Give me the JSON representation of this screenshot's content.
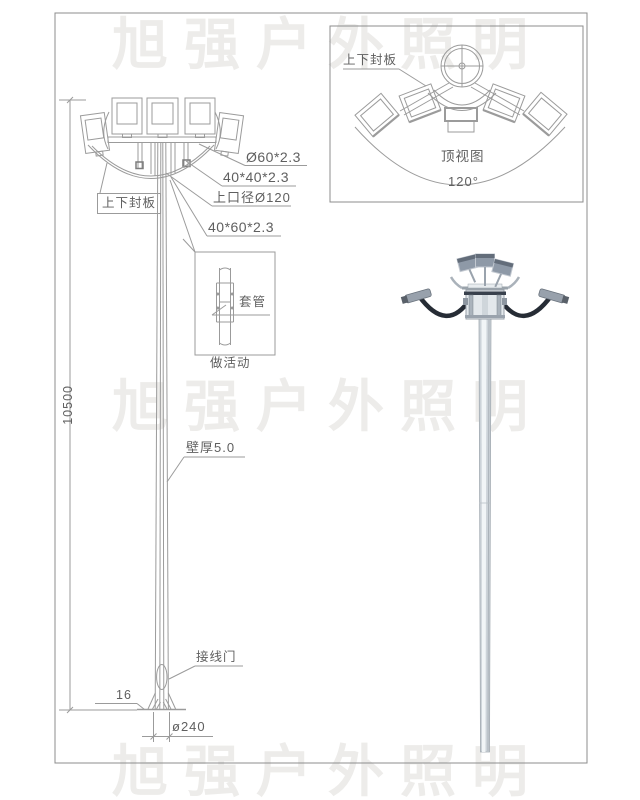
{
  "watermark": {
    "text": "旭强户外照明",
    "color": "#edecea"
  },
  "front_view": {
    "seal_plate": "上下封板",
    "lamp_arm_tube": "Ø60*2.3",
    "square_tube": "40*40*2.3",
    "top_opening": "上口径Ø120",
    "rect_tube": "40*60*2.3",
    "wall_thickness": "壁厚5.0",
    "pole_height": "10500",
    "wiring_door": "接线门",
    "base_plate_thickness": "16",
    "base_diameter": "ø240"
  },
  "sleeve_detail": {
    "sleeve": "套管",
    "caption": "做活动"
  },
  "top_view": {
    "seal_plate": "上下封板",
    "title": "顶视图",
    "angle": "120°"
  },
  "colors": {
    "line": "#9b9b9b",
    "frame": "#8c8c8c",
    "text": "#5f5f5f",
    "watermark": "#edecea",
    "arm_dark": "#262c35",
    "pole_light": "#ccd3d9",
    "lamp_face": "#8e99a7"
  }
}
